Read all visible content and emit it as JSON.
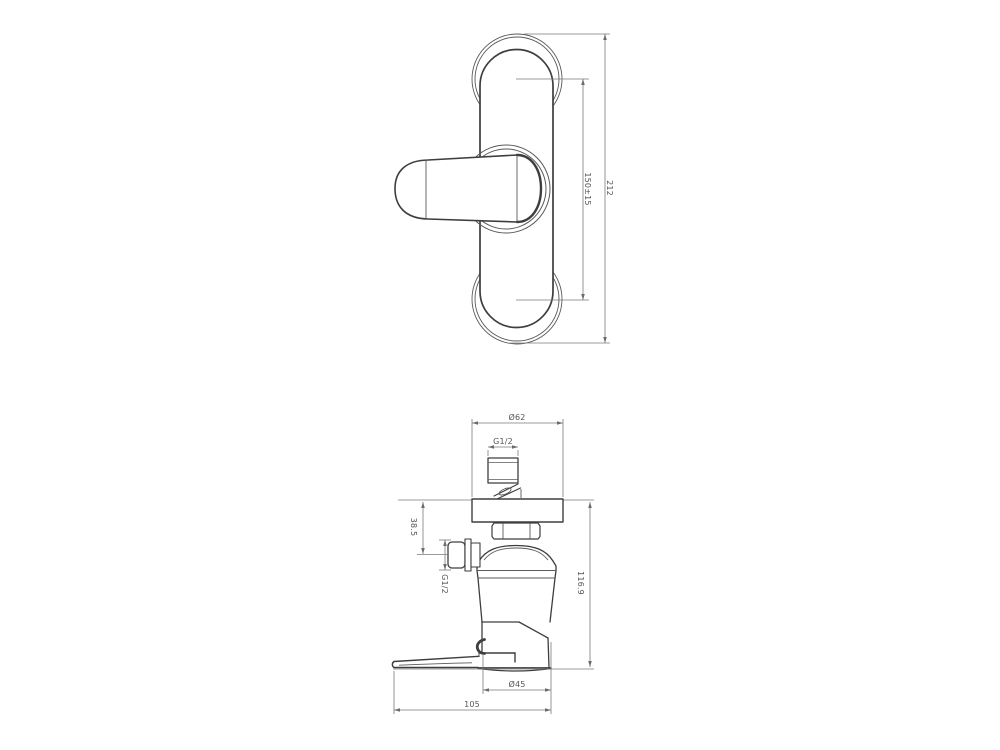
{
  "drawing": {
    "type": "technical-drawing",
    "front_view": {
      "dim_total_height": "212",
      "dim_center_spacing": "150±15"
    },
    "side_view": {
      "dim_flange_diameter": "Ø62",
      "dim_inlet_thread": "G1/2",
      "dim_outlet_offset": "38.5",
      "dim_outlet_thread": "G1/2",
      "dim_total_depth": "116.9",
      "dim_body_diameter": "Ø45",
      "dim_handle_projection": "105"
    },
    "colors": {
      "object_line": "#3e3e3e",
      "dimension_line": "#7a7a7a",
      "label_text": "#555555",
      "background": "#ffffff"
    }
  }
}
